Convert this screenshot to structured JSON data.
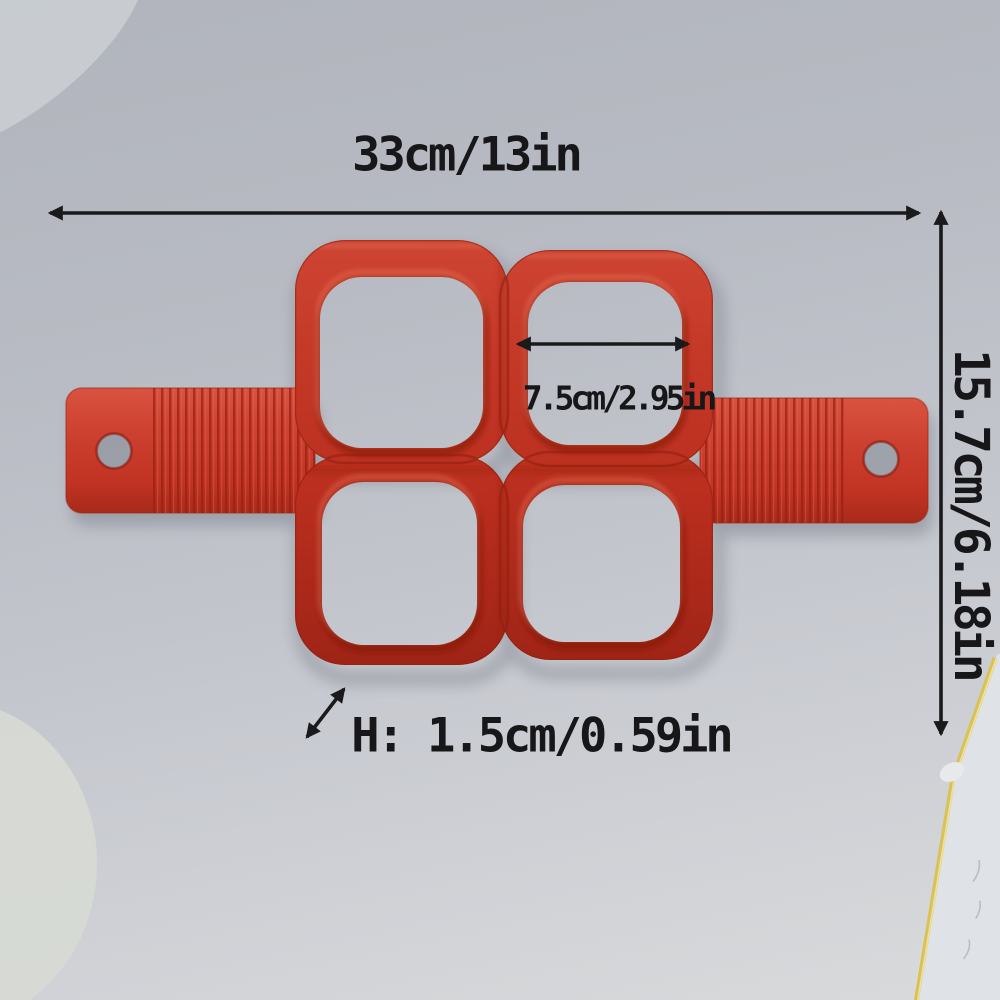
{
  "product": {
    "name": "red silicone 4-cavity pancake / egg ring mold with side handles",
    "cavity_count": 4,
    "colors": {
      "mold_red": "#bf3021",
      "handle_red": "#cf4530",
      "rim_shadow_red": "#7e150c",
      "rim_highlight_red": "#ea7a60",
      "annotation_black": "#1a1a1c",
      "background_gray": "#bdc0c8",
      "paper_edge_yellow": "#d8c25c"
    }
  },
  "annotations": {
    "width": "33cm/13in",
    "height": "15.7cm/6.18in",
    "cavity_width": "7.5cm/2.95in",
    "thickness": "H: 1.5cm/0.59in"
  }
}
